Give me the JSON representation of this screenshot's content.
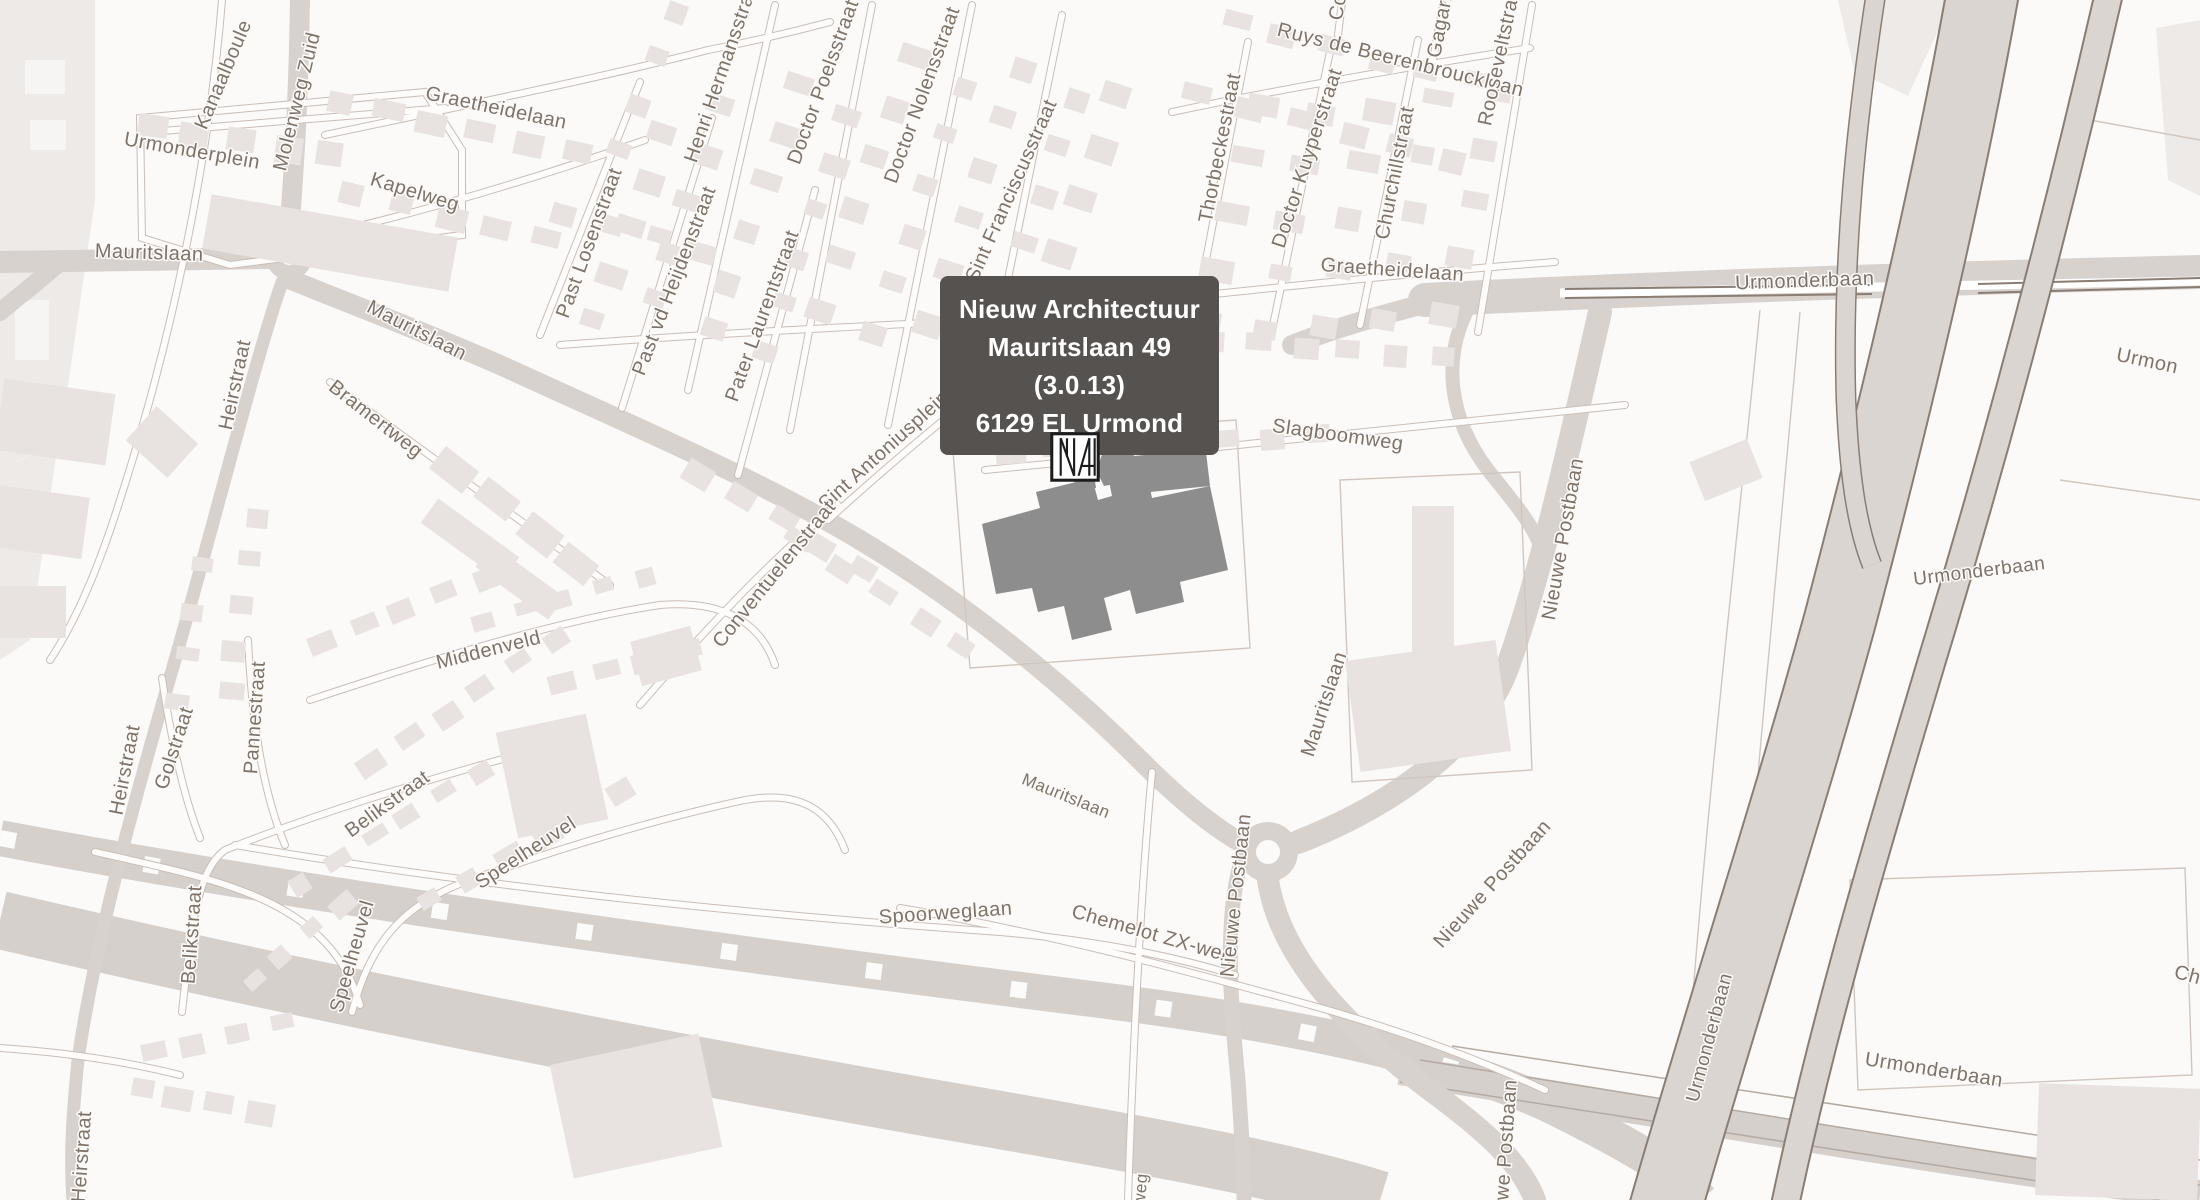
{
  "map": {
    "tooltip": {
      "line1": "Nieuw Architectuur",
      "line2": "Mauritslaan 49 (3.0.13)",
      "line3": "6129 EL Urmond"
    },
    "marker": {
      "name": "Nieuw Architectuur",
      "monogram": "NA"
    },
    "colors": {
      "land": "#fbfaf9",
      "parcel": "#edeae7",
      "building": "#e8e3e0",
      "road": "#d8d2cf",
      "road_casing": "#c9beb7",
      "road_fill": "#fdfcfb",
      "highway_fill": "#dbd5d1",
      "highway_edge": "#8a7d73",
      "railway": "#d6d0cc",
      "label": "#7f7268",
      "highlight_building": "#8d8d8d",
      "tooltip_bg": "#565250",
      "tooltip_text": "#ffffff",
      "marker_stroke": "#1c1c1c"
    },
    "street_labels": [
      {
        "text": "Kanaalboule",
        "x": 229,
        "y": 77,
        "rot": -67,
        "size": 20
      },
      {
        "text": "Urmonderplein",
        "x": 191,
        "y": 157,
        "rot": 10,
        "size": 20
      },
      {
        "text": "Mauritslaan",
        "x": 149,
        "y": 259,
        "rot": 2,
        "size": 20
      },
      {
        "text": "Molenweg Zuid",
        "x": 303,
        "y": 103,
        "rot": -76,
        "size": 20
      },
      {
        "text": "Graetheidelaan",
        "x": 495,
        "y": 114,
        "rot": 12,
        "size": 20
      },
      {
        "text": "Kapelweg",
        "x": 413,
        "y": 198,
        "rot": 17,
        "size": 20
      },
      {
        "text": "Past Losenstraat",
        "x": 595,
        "y": 245,
        "rot": -70,
        "size": 20
      },
      {
        "text": "Past vd Heijdenstraat",
        "x": 680,
        "y": 283,
        "rot": -69,
        "size": 20
      },
      {
        "text": "Henri Hermansstraat",
        "x": 728,
        "y": 72,
        "rot": -71,
        "size": 20
      },
      {
        "text": "Pater Laurentstraat",
        "x": 768,
        "y": 318,
        "rot": -70,
        "size": 20
      },
      {
        "text": "Doctor Poelsstraat",
        "x": 829,
        "y": 84,
        "rot": -70,
        "size": 20
      },
      {
        "text": "Doctor Nolensstraat",
        "x": 928,
        "y": 97,
        "rot": -70,
        "size": 20
      },
      {
        "text": "Sint Franciscusstraat",
        "x": 1017,
        "y": 193,
        "rot": -66,
        "size": 20
      },
      {
        "text": "Ruys de Beerenbroucklaan",
        "x": 1399,
        "y": 66,
        "rot": 14,
        "size": 20
      },
      {
        "text": "Thorbeckestraat",
        "x": 1226,
        "y": 149,
        "rot": -79,
        "size": 20
      },
      {
        "text": "Doctor Kuyperstraat",
        "x": 1313,
        "y": 160,
        "rot": -72,
        "size": 20
      },
      {
        "text": "Churchillstraat",
        "x": 1401,
        "y": 174,
        "rot": -79,
        "size": 20
      },
      {
        "text": "Gagarin",
        "x": 1447,
        "y": 22,
        "rot": -79,
        "size": 20
      },
      {
        "text": "Rooseveltstraat",
        "x": 1506,
        "y": 55,
        "rot": -78,
        "size": 20
      },
      {
        "text": "Co",
        "x": 1344,
        "y": 8,
        "rot": -80,
        "size": 20
      },
      {
        "text": "Graetheidelaan",
        "x": 1392,
        "y": 276,
        "rot": 4,
        "size": 20
      },
      {
        "text": "Slagboomweg",
        "x": 1337,
        "y": 441,
        "rot": 8,
        "size": 20
      },
      {
        "text": "Heirstraat",
        "x": 241,
        "y": 386,
        "rot": -78,
        "size": 20
      },
      {
        "text": "Mauritslaan",
        "x": 414,
        "y": 336,
        "rot": 27,
        "size": 20
      },
      {
        "text": "Bramertweg",
        "x": 372,
        "y": 424,
        "rot": 38,
        "size": 20
      },
      {
        "text": "Sint Antoniusplein",
        "x": 888,
        "y": 455,
        "rot": -42,
        "size": 20
      },
      {
        "text": "Conventuelenstraat",
        "x": 779,
        "y": 578,
        "rot": -51,
        "size": 20
      },
      {
        "text": "Middenveld",
        "x": 490,
        "y": 656,
        "rot": -14,
        "size": 20
      },
      {
        "text": "Heirstraat",
        "x": 131,
        "y": 771,
        "rot": -79,
        "size": 20
      },
      {
        "text": "Golstraat",
        "x": 180,
        "y": 750,
        "rot": -72,
        "size": 20
      },
      {
        "text": "Pannestraat",
        "x": 261,
        "y": 718,
        "rot": -86,
        "size": 20
      },
      {
        "text": "Belikstraat",
        "x": 391,
        "y": 809,
        "rot": -36,
        "size": 20
      },
      {
        "text": "Belikstraat",
        "x": 198,
        "y": 935,
        "rot": -86,
        "size": 20
      },
      {
        "text": "Speelheuvel",
        "x": 529,
        "y": 858,
        "rot": -33,
        "size": 20
      },
      {
        "text": "Speelheuvel",
        "x": 358,
        "y": 958,
        "rot": -74,
        "size": 20
      },
      {
        "text": "Spoorweglaan",
        "x": 946,
        "y": 919,
        "rot": -4,
        "size": 20
      },
      {
        "text": "Chemelot ZX-weg",
        "x": 1151,
        "y": 940,
        "rot": 16,
        "size": 20
      },
      {
        "text": "Mauritslaan",
        "x": 1064,
        "y": 801,
        "rot": 22,
        "size": 17
      },
      {
        "text": "Mauritslaan",
        "x": 1330,
        "y": 706,
        "rot": -72,
        "size": 20
      },
      {
        "text": "Nieuwe Postbaan",
        "x": 1242,
        "y": 896,
        "rot": -84,
        "size": 20
      },
      {
        "text": "Nieuwe Postbaan",
        "x": 1497,
        "y": 888,
        "rot": -48,
        "size": 20
      },
      {
        "text": "uwe Postbaan",
        "x": 1512,
        "y": 1146,
        "rot": -86,
        "size": 20
      },
      {
        "text": "Nieuwe Postbaan",
        "x": 1569,
        "y": 540,
        "rot": -80,
        "size": 20
      },
      {
        "text": "Urmonderbaan",
        "x": 1805,
        "y": 287,
        "rot": -2,
        "size": 20
      },
      {
        "text": "Urmon",
        "x": 2146,
        "y": 367,
        "rot": 12,
        "size": 20
      },
      {
        "text": "Urmonderbaan",
        "x": 1980,
        "y": 577,
        "rot": -7,
        "size": 19
      },
      {
        "text": "Urmonderbaan",
        "x": 1715,
        "y": 1039,
        "rot": -75,
        "size": 19
      },
      {
        "text": "Urmonderbaan",
        "x": 1933,
        "y": 1076,
        "rot": 9,
        "size": 20
      },
      {
        "text": "Heirstraat",
        "x": 88,
        "y": 1157,
        "rot": -86,
        "size": 20
      },
      {
        "text": "Ch",
        "x": 2186,
        "y": 981,
        "rot": 15,
        "size": 20
      },
      {
        "text": "weg",
        "x": 1146,
        "y": 1190,
        "rot": -85,
        "size": 17
      }
    ]
  }
}
